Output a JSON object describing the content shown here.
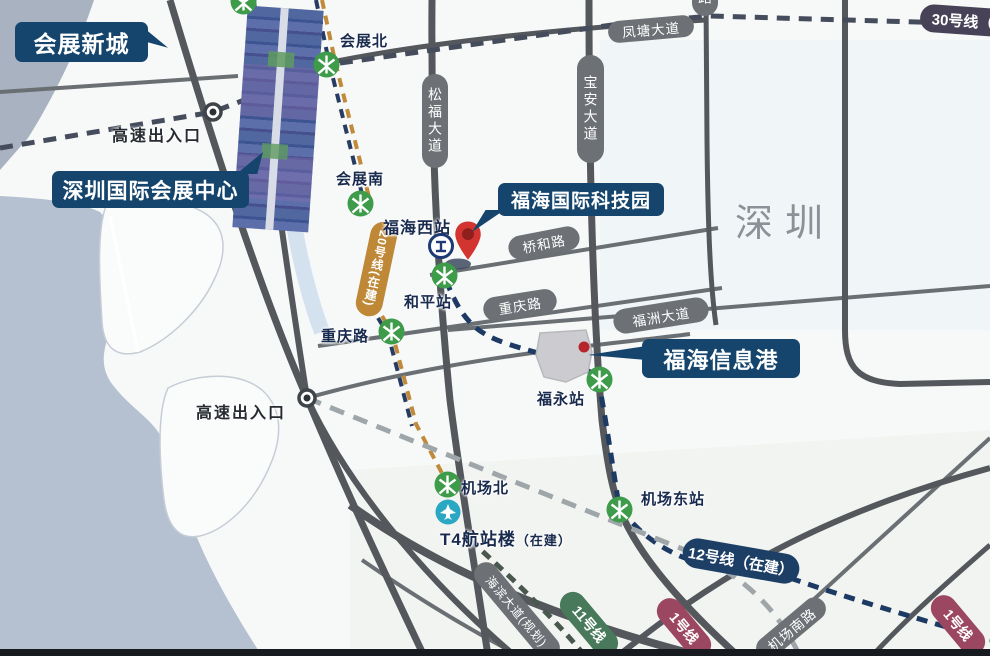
{
  "region": {
    "name": "深圳"
  },
  "callouts": {
    "new_town": "会展新城",
    "convention_center": "深圳国际会展中心",
    "tech_park": "福海国际科技园",
    "info_port": "福海信息港"
  },
  "stations": {
    "huizhan_north": "会展北",
    "huizhan_south": "会展南",
    "fuhai_west": "福海西站",
    "heping": "和平站",
    "fuyong": "福永站",
    "jichang_north": "机场北",
    "jichang_east": "机场东站",
    "t4": {
      "name": "T4航站楼",
      "status": "（在建）"
    }
  },
  "roads": {
    "fengtang": "凤塘大道",
    "songfu": "松福大道",
    "baoan": "宝安大道",
    "qiaohe": "桥和路",
    "chongqing": "重庆路",
    "chongqing_text": "重庆路",
    "fuzhou": "福洲大道",
    "jichang_south": "机场南路",
    "haibin": "海滨大道(规划)",
    "top_partial": "路"
  },
  "metro_lines": {
    "line20": "20号线(在建)",
    "line12": "12号线（在建）",
    "line30": "30号线（在建）",
    "line11": "11号线",
    "line1": "1号线"
  },
  "markers": {
    "expressway_exit": "高速出入口"
  },
  "icons": {
    "metro": "shenzhen-metro-icon",
    "railway": "railway-station-icon",
    "airplane": "airplane-icon",
    "pin": "location-pin-icon"
  },
  "colors": {
    "callout_navy": "#15456d",
    "pill_gray": "#6d7176",
    "metro_green": "#3d9b4a",
    "line20_orange": "#bf8837",
    "line12_navy": "#1d3f66",
    "line30_purple": "#474257",
    "line11_green": "#47795a",
    "line1_maroon": "#9c4761",
    "pin_red": "#d23430",
    "water": "#b5c1d1"
  }
}
